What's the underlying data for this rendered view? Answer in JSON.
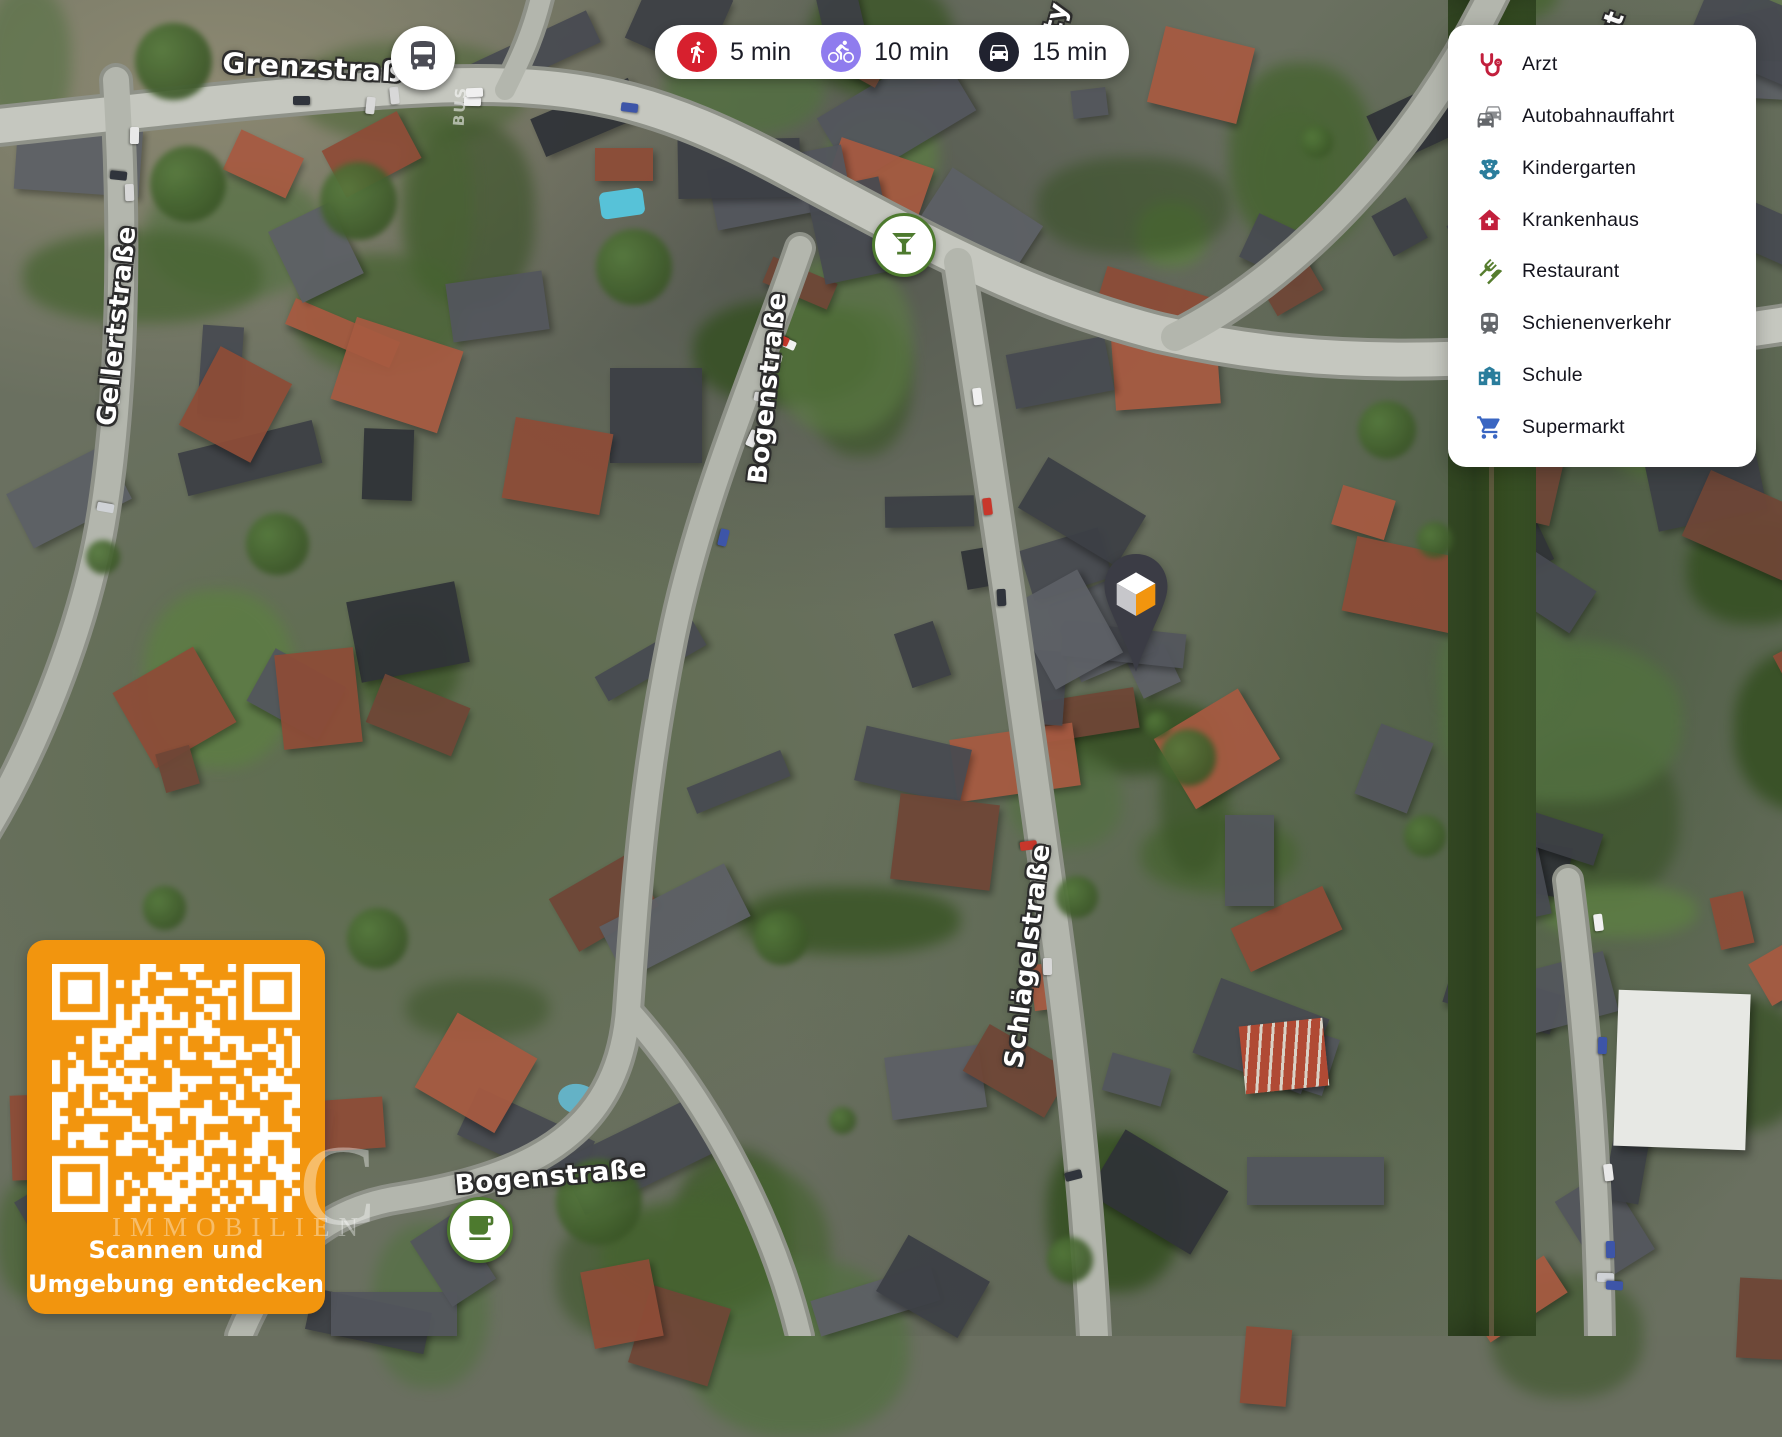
{
  "travel_times": {
    "items": [
      {
        "mode": "walk",
        "icon": "walking-person-icon",
        "label": "5 min",
        "color": "#d7202e"
      },
      {
        "mode": "bike",
        "icon": "cyclist-icon",
        "label": "10 min",
        "color": "#8f7cee"
      },
      {
        "mode": "car",
        "icon": "car-icon",
        "label": "15 min",
        "color": "#20222f"
      }
    ]
  },
  "legend": {
    "items": [
      {
        "id": "arzt",
        "icon": "stethoscope-icon",
        "label": "Arzt",
        "color": "#c21f3c"
      },
      {
        "id": "autobahnauffahrt",
        "icon": "highway-cars-icon",
        "label": "Autobahnauffahrt",
        "color": "#64676b"
      },
      {
        "id": "kindergarten",
        "icon": "teddy-bear-icon",
        "label": "Kindergarten",
        "color": "#2a7d9c"
      },
      {
        "id": "krankenhaus",
        "icon": "hospital-house-icon",
        "label": "Krankenhaus",
        "color": "#c21f3c"
      },
      {
        "id": "restaurant",
        "icon": "fork-knife-icon",
        "label": "Restaurant",
        "color": "#567d2e"
      },
      {
        "id": "schienenverkehr",
        "icon": "train-icon",
        "label": "Schienenverkehr",
        "color": "#64676b"
      },
      {
        "id": "schule",
        "icon": "school-building-icon",
        "label": "Schule",
        "color": "#2a7d9c"
      },
      {
        "id": "supermarkt",
        "icon": "shopping-cart-icon",
        "label": "Supermarkt",
        "color": "#3a66c2"
      }
    ]
  },
  "map": {
    "street_labels": {
      "grenzstrasse": "Grenzstraße",
      "gellertstrasse": "Gellertstraße",
      "bogenstrasse_mid": "Bogenstraße",
      "schlaegelstrasse": "Schlägelstraße",
      "bogenstrasse_bottom": "Bogenstraße",
      "partial_top": "ty",
      "partial_top_right": "st"
    },
    "road_paint": "BUS",
    "poi_markers": [
      {
        "type": "bus-stop"
      },
      {
        "type": "cocktail-bar"
      },
      {
        "type": "cafe"
      },
      {
        "type": "property-pin"
      }
    ]
  },
  "qr_panel": {
    "line1": "Scannen und",
    "line2": "Umgebung entdecken",
    "background": "#f2950e"
  },
  "watermark": {
    "big_letter": "C",
    "text": "IMMOBILIEN"
  },
  "colors": {
    "brand_orange": "#f2950e",
    "walk_red": "#d7202e",
    "bike_purple": "#8f7cee",
    "car_dark": "#20222f",
    "poi_green": "#4d7a2e",
    "pin_charcoal": "#3b3c45"
  }
}
